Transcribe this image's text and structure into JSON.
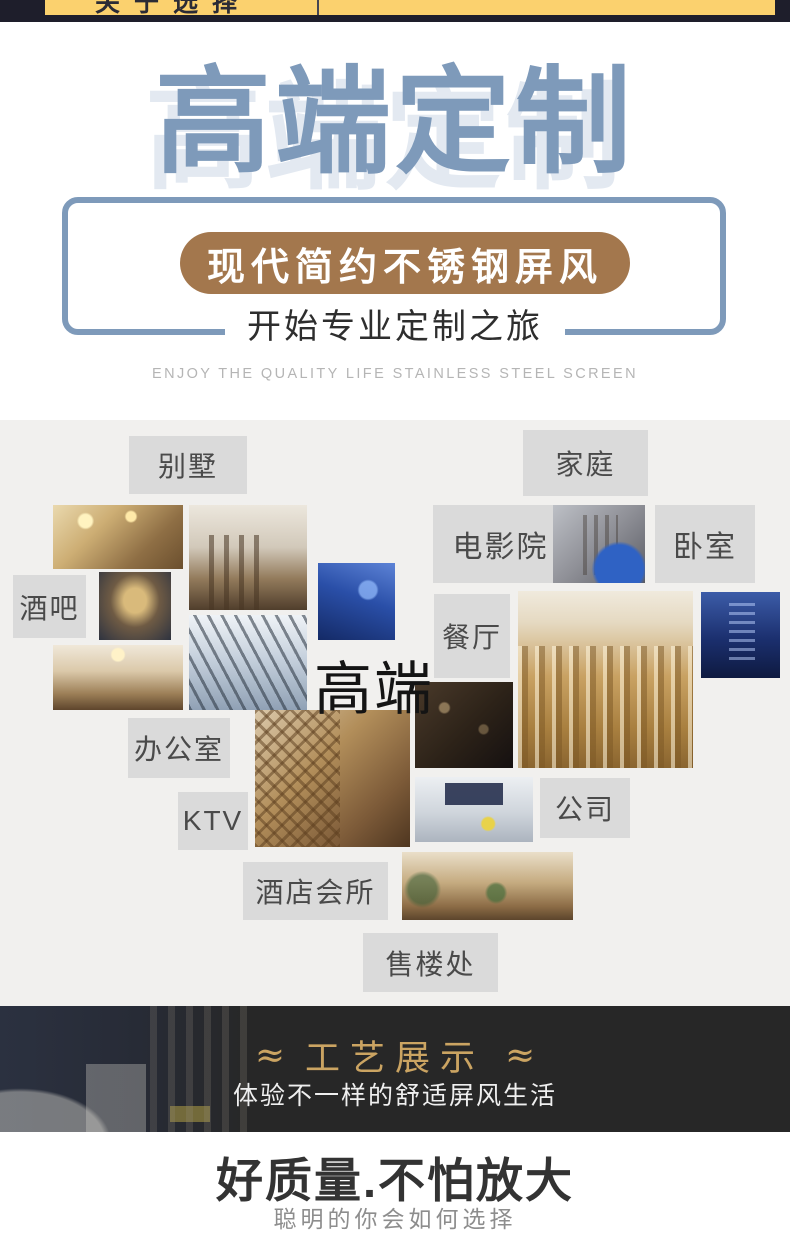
{
  "top_bar": {
    "tab_label": "关于选择"
  },
  "hero": {
    "title": "高端定制",
    "badge": "现代简约不锈钢屏风",
    "journey": "开始专业定制之旅",
    "tagline_en": "ENJOY THE QUALITY LIFE STAINLESS STEEL SCREEN",
    "colors": {
      "accent_blue": "#7E9ABA",
      "badge_brown": "#A3774D"
    }
  },
  "scenes": {
    "center_highlight": "高端",
    "labels": {
      "villa": "别墅",
      "family": "家庭",
      "cinema": "电影院",
      "bedroom": "卧室",
      "bar": "酒吧",
      "restaurant": "餐厅",
      "office": "办公室",
      "ktv": "KTV",
      "company": "公司",
      "hotel_club": "酒店会所",
      "sales_office": "售楼处"
    }
  },
  "craft": {
    "ornament": "≈",
    "title": "工艺展示",
    "subtitle": "体验不一样的舒适屏风生活",
    "colors": {
      "gold": "#CBA462",
      "background": "#272727"
    }
  },
  "quality": {
    "headline": "好质量.不怕放大",
    "subline": "聪明的你会如何选择"
  }
}
